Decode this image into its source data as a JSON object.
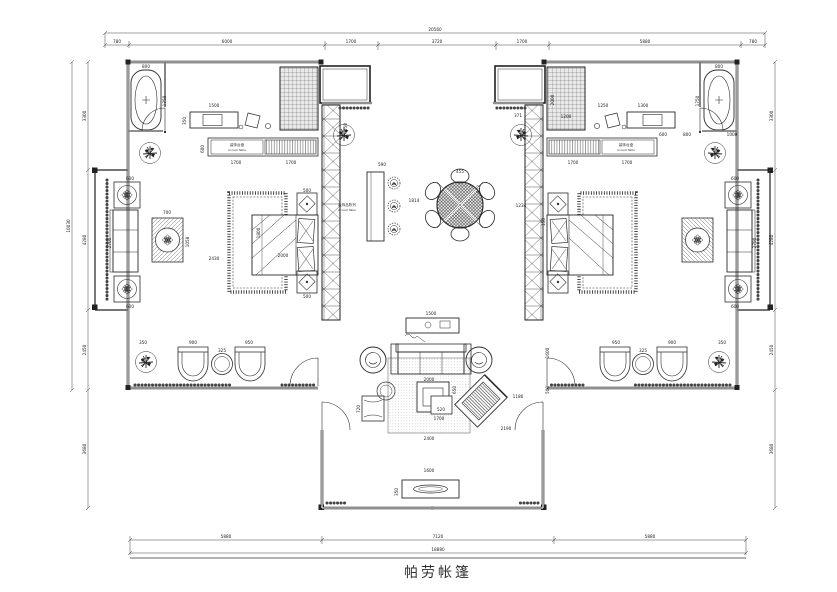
{
  "title": {
    "text": "帕劳帐篷"
  },
  "colors": {
    "line": "#2b2b2b",
    "dimline": "#444444",
    "bg": "#ffffff",
    "fill_light": "#ececec"
  },
  "cabinet_left": {
    "cn": "装饰台盘",
    "en": "Accent Table"
  },
  "cabinet_right": {
    "cn": "装饰台盘",
    "en": "Accent Table"
  },
  "bar_label": {
    "cn": "装饰品陈列",
    "en": "Accent Table"
  },
  "dims": {
    "top": [
      "780",
      "6000",
      "1700",
      "3720",
      "1700",
      "5880",
      "780"
    ],
    "top_total": "20560",
    "bottom": [
      "5880",
      "7120",
      "5880"
    ],
    "bottom_total": "18880",
    "left": [
      "3300",
      "4280",
      "2450",
      "3680"
    ],
    "left_total": "10030",
    "right": [
      "3300",
      "4280",
      "2450",
      "3680"
    ],
    "labels": [
      "800",
      "1750",
      "1500",
      "350",
      "600",
      "1700",
      "1700",
      "700",
      "1058",
      "2430",
      "1800",
      "2000",
      "500",
      "500",
      "600",
      "2700",
      "600",
      "350",
      "900",
      "325",
      "950",
      "550",
      "590",
      "1814",
      "455",
      "812",
      "1234",
      "371",
      "1500",
      "2000",
      "650",
      "520",
      "1700",
      "2400",
      "2190",
      "1186",
      "720",
      "1600",
      "350",
      "1600",
      "500",
      "2000",
      "1200",
      "1250",
      "1300",
      "800",
      "1750",
      "1700",
      "1700",
      "1000",
      "600",
      "2700",
      "600",
      "950",
      "325",
      "900",
      "350",
      "150",
      "600",
      "800"
    ]
  }
}
